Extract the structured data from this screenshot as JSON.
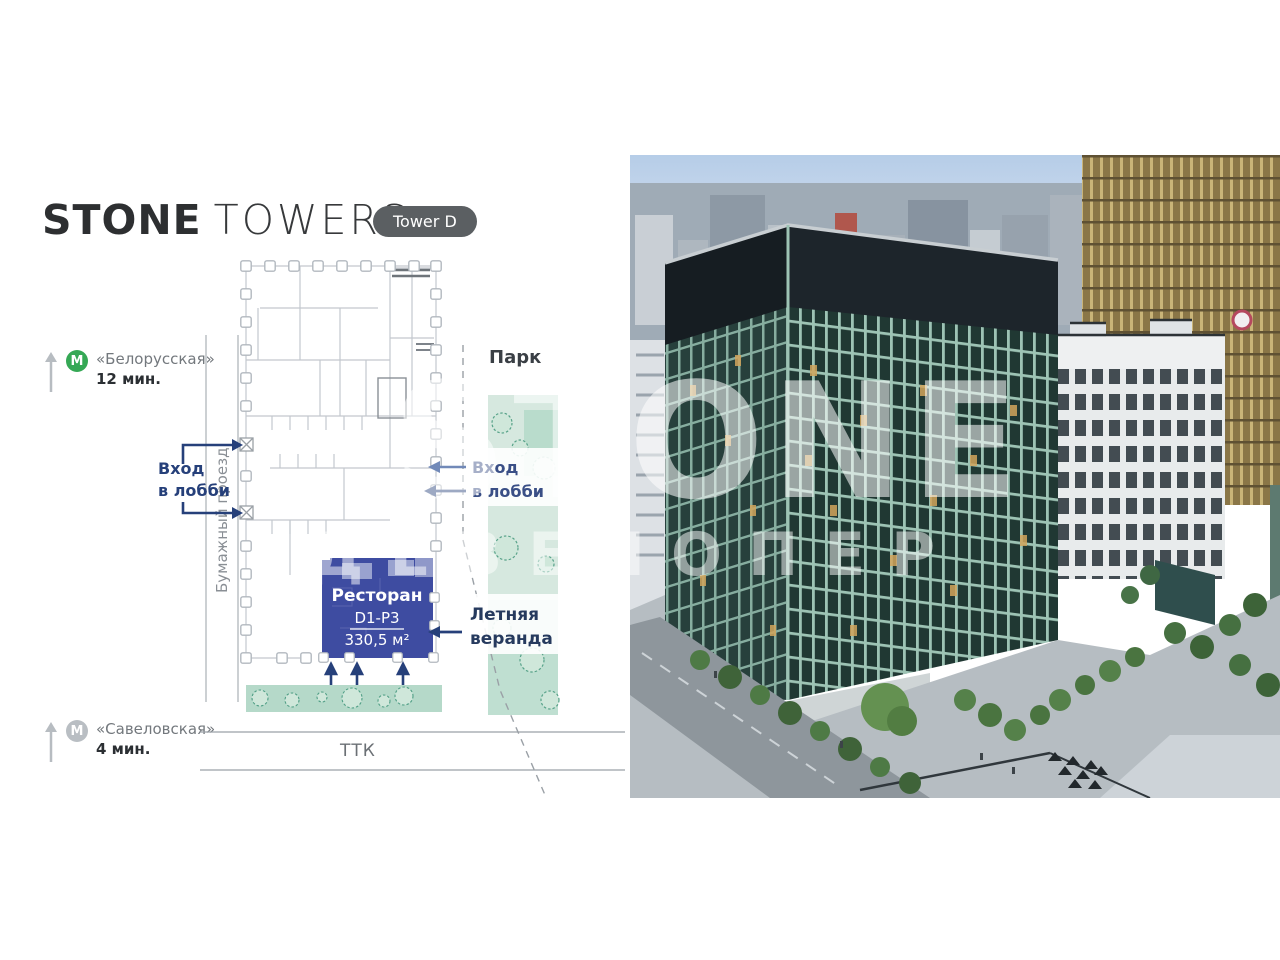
{
  "brand": {
    "name_bold": "STONE",
    "name_light": "TOWERS",
    "tower_badge": "Tower D"
  },
  "stations": {
    "top": {
      "line_icon": "M",
      "name": "«Белорусская»",
      "walk_time": "12 мин."
    },
    "bottom": {
      "line_icon": "M",
      "name": "«Савеловская»",
      "walk_time": "4 мин."
    }
  },
  "plan": {
    "park_label": "Парк",
    "street_label": "Бумажный проезд",
    "highway_label": "ТТК",
    "lobby_entrance_left": [
      "Вход",
      "в лобби"
    ],
    "lobby_entrance_right": [
      "Вход",
      "в лобби"
    ],
    "summer_terrace": [
      "Летняя",
      "веранда"
    ],
    "unit": {
      "name": "Ресторан",
      "code": "D1-P3",
      "area": "330,5 м²"
    }
  },
  "watermark": {
    "line1": "STONE",
    "line2": "ДЕВЕЛОПЕР"
  },
  "colors": {
    "unit_blue": "#3e4ca1",
    "unit_blue_light": "#99a2cf",
    "navy": "#26407a",
    "metro_green": "#35a855",
    "metro_gray": "#b9bec3",
    "park_teal_light": "#d6e8df",
    "park_teal_dark": "#b9dccc",
    "badge_gray": "#5b5f62",
    "tower_green": "#2a433e",
    "tower_top_dark": "#1d252b"
  }
}
